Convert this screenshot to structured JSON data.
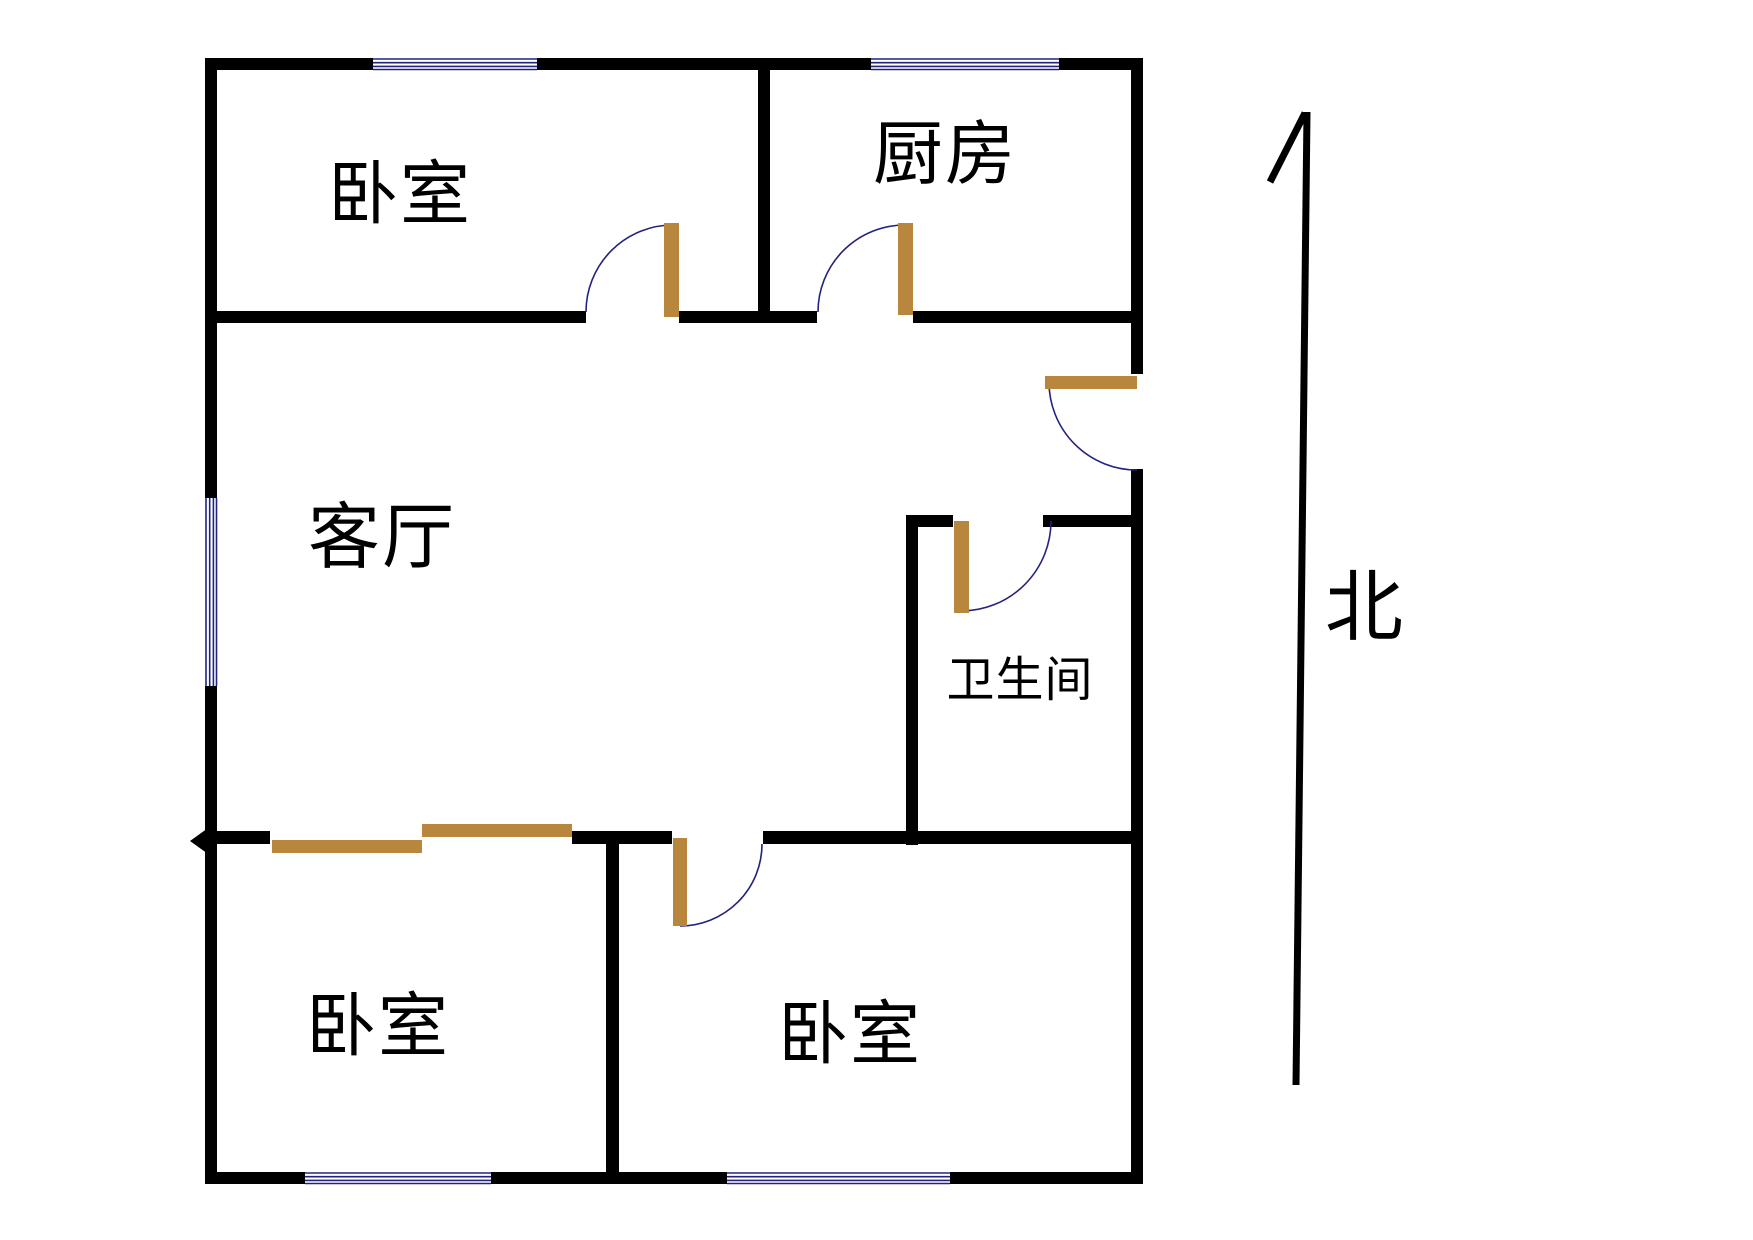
{
  "rooms": {
    "bedroom_nw": {
      "label": "卧室"
    },
    "kitchen": {
      "label": "厨房"
    },
    "living_room": {
      "label": "客厅"
    },
    "bathroom": {
      "label": "卫生间"
    },
    "bedroom_sw": {
      "label": "卧室"
    },
    "bedroom_se": {
      "label": "卧室"
    }
  },
  "compass": {
    "label": "北"
  },
  "colors": {
    "wall": "#000000",
    "door_leaf": "#B8873D",
    "window_and_arc_line": "#23237E",
    "background": "#FFFFFF"
  }
}
